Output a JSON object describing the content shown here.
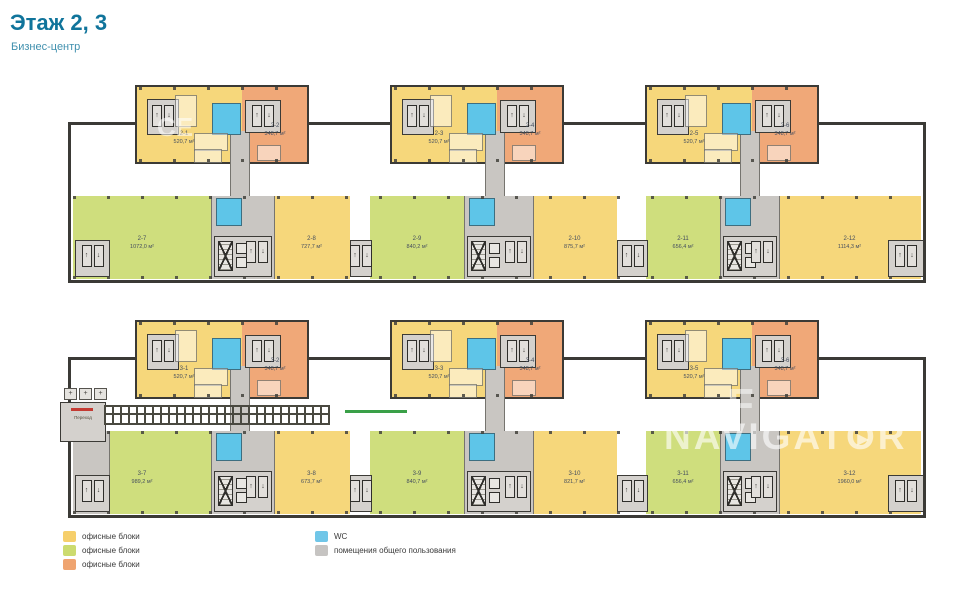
{
  "header": {
    "title": "Этаж 2, 3",
    "subtitle": "Бизнес-центр"
  },
  "legend": {
    "items": [
      {
        "label": "офисные блоки",
        "color": "#F6CF6B"
      },
      {
        "label": "офисные блоки",
        "color": "#CCDB6F"
      },
      {
        "label": "офисные блоки",
        "color": "#EFA470"
      },
      {
        "label": "WC",
        "color": "#70C6E8"
      },
      {
        "label": "помещения общего пользования",
        "color": "#C6C4C2"
      }
    ]
  },
  "watermark": {
    "brand_pre": "NAVIGAT",
    "brand_o": "O",
    "brand_post": "R",
    "play_icon": "▶",
    "fragment_top": "СЕ",
    "fragment_mid": "F"
  },
  "icons": {
    "elevator_up": "↑",
    "elevator_down": "↓",
    "plus": "+"
  },
  "colors": {
    "office_yellow": "#F6D77B",
    "office_green": "#CFDE7D",
    "office_orange": "#F0A878",
    "wc_blue": "#5EC5E8",
    "common_gray": "#C9C6C2",
    "machine_gray": "#D4D1CD",
    "wall_dark": "#3B3A36",
    "line_gray": "#76746F",
    "red_mark": "#C43B33",
    "green_mark": "#3AA048",
    "label_ink": "#454E5E",
    "accent_teal": "#10749B"
  },
  "floors": [
    {
      "name": "floor-2",
      "left_common": false,
      "towers": [
        {
          "units": [
            {
              "id": "2-1",
              "area": "520,7 м²",
              "color": "yellow"
            },
            {
              "id": "2-2",
              "area": "348,7 м²",
              "color": "orange"
            }
          ]
        },
        {
          "units": [
            {
              "id": "2-3",
              "area": "520,7 м²",
              "color": "yellow"
            },
            {
              "id": "2-4",
              "area": "348,7 м²",
              "color": "orange"
            }
          ]
        },
        {
          "units": [
            {
              "id": "2-5",
              "area": "520,7 м²",
              "color": "yellow"
            },
            {
              "id": "2-6",
              "area": "348,7 м²",
              "color": "orange"
            }
          ]
        }
      ],
      "strip": [
        {
          "id": "2-7",
          "area": "1072,0 м²",
          "color": "green"
        },
        {
          "id": "2-8",
          "area": "727,7 м²",
          "color": "yellow"
        },
        {
          "id": "2-9",
          "area": "840,2 м²",
          "color": "green"
        },
        {
          "id": "2-10",
          "area": "875,7 м²",
          "color": "yellow"
        },
        {
          "id": "2-11",
          "area": "656,4 м²",
          "color": "green"
        },
        {
          "id": "2-12",
          "area": "1114,3 м²",
          "color": "yellow"
        }
      ],
      "bridge": null
    },
    {
      "name": "floor-3",
      "left_common": true,
      "towers": [
        {
          "units": [
            {
              "id": "3-1",
              "area": "520,7 м²",
              "color": "yellow"
            },
            {
              "id": "3-2",
              "area": "348,7 м²",
              "color": "orange"
            }
          ]
        },
        {
          "units": [
            {
              "id": "3-3",
              "area": "520,7 м²",
              "color": "yellow"
            },
            {
              "id": "3-4",
              "area": "348,7 м²",
              "color": "orange"
            }
          ]
        },
        {
          "units": [
            {
              "id": "3-5",
              "area": "520,7 м²",
              "color": "yellow"
            },
            {
              "id": "3-6",
              "area": "348,7 м²",
              "color": "orange"
            }
          ]
        }
      ],
      "strip": [
        {
          "id": "3-7",
          "area": "989,2 м²",
          "color": "green"
        },
        {
          "id": "3-8",
          "area": "673,7 м²",
          "color": "yellow"
        },
        {
          "id": "3-9",
          "area": "840,7 м²",
          "color": "green"
        },
        {
          "id": "3-10",
          "area": "821,7 м²",
          "color": "yellow"
        },
        {
          "id": "3-11",
          "area": "656,4 м²",
          "color": "green"
        },
        {
          "id": "3-12",
          "area": "1960,0 м²",
          "color": "yellow"
        }
      ],
      "bridge": {
        "label": "Переход"
      }
    }
  ]
}
